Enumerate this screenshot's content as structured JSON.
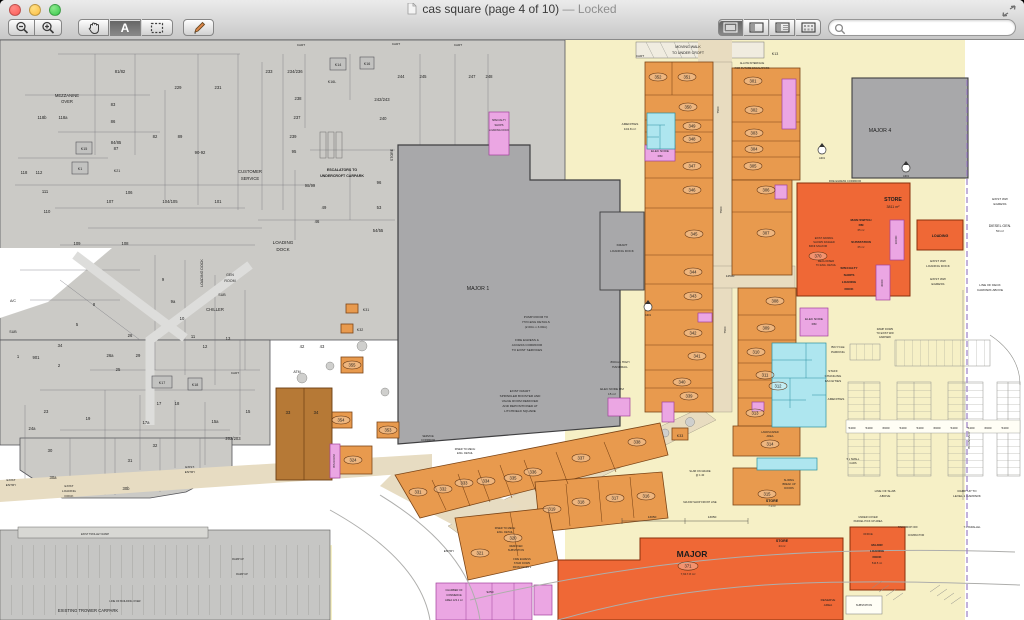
{
  "chrome": {
    "title": "cas square (page 4 of 10)",
    "locked": "— Locked",
    "search_placeholder": ""
  },
  "plan": {
    "maj": {
      "m1": "MAJOR 1",
      "m4": "MAJOR 4",
      "major": "MAJOR",
      "area371": "7,617.8 m²",
      "store": "STORE",
      "store_area": "3811 m²",
      "s71": "7.1 m²",
      "s24": "24 m²",
      "mini": "MINI MAJOR",
      "loading": "LOADING",
      "mld1": "MAJOR",
      "mld2": "LOADING",
      "mld3": "DOCK",
      "mld_area": "510.5 m²"
    },
    "shops": {
      "s301": "301",
      "s302": "302",
      "s303": "303",
      "s304": "304",
      "s305": "305",
      "s306": "306",
      "s307": "307",
      "s308": "308",
      "s309": "309",
      "s310": "310",
      "s311": "311",
      "s312": "312",
      "s313": "313",
      "s314": "314",
      "s315": "315",
      "s316": "316",
      "s317": "317",
      "s318": "318",
      "s319": "319",
      "s320": "320",
      "s321": "321",
      "s324": "324",
      "s331": "331",
      "s332": "332",
      "s333": "333",
      "s334": "334",
      "s335": "335",
      "s336": "336",
      "s337": "337",
      "s338": "338",
      "s339": "339",
      "s340": "340",
      "s341": "341",
      "s342": "342",
      "s343": "343",
      "s344": "344",
      "s345": "345",
      "s346": "346",
      "s347": "347",
      "s348": "348",
      "s349": "349",
      "s350": "350",
      "s351": "351",
      "s352": "352",
      "s353": "353",
      "s354": "354",
      "s355": "355",
      "s370": "370",
      "s371": "371"
    },
    "ex": {
      "u81_82": "81/82",
      "u83": "83",
      "u84_85": "84/85",
      "u87": "87",
      "u86": "86",
      "u82": "82",
      "u89": "89",
      "u90_92": "90-92",
      "u229": "229",
      "u231": "231",
      "u233": "233",
      "u234_236": "234/236",
      "u237": "237",
      "u238": "238",
      "u239": "239",
      "u240": "240",
      "u242_243": "242/243",
      "u244": "244",
      "u245": "245",
      "u247": "247",
      "u248": "248",
      "u95": "95",
      "u96": "96",
      "u98_99": "98/99",
      "u53": "53",
      "u54_55": "54/55",
      "u49": "49",
      "u46": "46",
      "u101": "101",
      "u104_105": "104/105",
      "u106": "106",
      "u107": "107",
      "u108": "108",
      "u109": "109",
      "u110": "110",
      "u111": "111",
      "u112": "112",
      "u118": "118",
      "u118a": "118a",
      "u118b": "118b",
      "u1": "1",
      "u2": "2",
      "u5": "5",
      "u8": "8",
      "u9": "9",
      "u9a": "9a",
      "u10": "10",
      "u11": "11",
      "u12": "12",
      "u13": "13",
      "u15": "15",
      "u15a": "15a",
      "u17": "17",
      "u17a": "17a",
      "u18": "18",
      "u19": "19",
      "u23": "23",
      "u24a": "24a",
      "u25": "25",
      "u26": "26",
      "u26a": "26a",
      "u29": "29",
      "u30": "30",
      "u30a": "30a",
      "u30b": "30b",
      "u31": "31",
      "u32": "32",
      "u33": "33",
      "u34": "34",
      "u34w": "34",
      "u42": "42",
      "u43": "43",
      "u901": "901",
      "u202_203": "202/203"
    },
    "k": {
      "k1": "K1",
      "k13": "K13",
      "k14": "K14",
      "k15": "K15",
      "k16": "K16",
      "k16l": "K16L",
      "k17": "K17",
      "k18": "K18",
      "k21": "K21",
      "k31": "K31",
      "k32": "K32",
      "k33": "K33"
    },
    "d": {
      "d7500": "7500",
      "d14500": "14500",
      "d13050": "13050",
      "d9250": "9250",
      "d5400": "5400",
      "d6600": "6600",
      "d6000": "6000",
      "d10000": "10000"
    },
    "n": {
      "mw1": "MOVING WALK",
      "mw2": "TO UNDER CROFT",
      "ai1": "ALLOW INTERFACE",
      "ai2": "FOR FUTURE ESCALATORS",
      "cart": "CART",
      "mz1": "MEZZANINE",
      "mz2": "OVER",
      "cs1": "CUSTOMER",
      "cs2": "SERVICE",
      "es1": "ESCALATORS TO",
      "es2": "UNDERCROFT CARPARK",
      "ld1": "LOADING",
      "ld2": "DOCK",
      "ldv": "LOADING DOCK",
      "gr1": "GEN",
      "gr2": "ROOM",
      "sub": "SUB",
      "chiller": "CHILLER",
      "ac": "A/C",
      "atm": "ATM",
      "storev": "STORE",
      "pump1": "PUMP ROOM TO",
      "pump2": "HYD.ENG DETAILS",
      "pump3": "(2.00m x 3.00m)",
      "fc1": "FIRE EGRESS &",
      "fc2": "ACCESS CORRIDOR",
      "fc3": "TO EXIST SERVICES",
      "km1": "EXIST KMART",
      "km2": "SPRINKLER BOOSTER AND",
      "km3": "VALVE ROOM REMOVED",
      "km4": "AND REPOSITIONED AT",
      "km5": "LITCHFIELD SQUARE",
      "kld1": "KMART",
      "kld2": "LOADING DOCK",
      "msw1": "MAIN SWITCH",
      "msw2": "RM",
      "a65": "65 m²",
      "sst": "SUBSTATION",
      "sp1": "SPECIALTY",
      "sp2": "SHOPS",
      "sp3": "LOADING",
      "sp4": "DOCK",
      "sp5": "LOADING DOCK",
      "am1": "AMENITIES",
      "am2": "104.8 m²",
      "en1": "ELEC NODE",
      "en2": "RM",
      "en3": "ELEC NODE RM",
      "en4": "15 m²",
      "mr1": "MECH RISER",
      "mr2": "TO ENG. DETAIL",
      "aw1": "EXIST AWNING",
      "aw2": "SHOWN DASHED",
      "we1": "EXIST WW",
      "we2": "EGRESS",
      "wl2": "LOADING DOCK",
      "dg1": "DIESEL GEN.",
      "dg2": "50 m²",
      "dk1": "LINE OF DECK",
      "dk2": "CARPARK ABOVE",
      "bd": "BOUNDARY",
      "bk1": "BICYCLE",
      "bk2": "PARKING",
      "st1": "STAFF",
      "st2": "CHANGING",
      "st3": "FACILITIES",
      "rd1": "RAMP DOWN",
      "rd2": "TO EXIST WW",
      "rd3": "CARPARK",
      "ru1": "RAMP UP TO",
      "ru2": "LEVEL 1 CARPARK",
      "ru": "RAMP UP",
      "sl1": "LINE OF SLAB",
      "sl2": "ABOVE",
      "lb1": "LINE OF BUILDING OVER",
      "pc1": "UNDER COVER",
      "pc2": "PARCEL PICK UP AREA",
      "tx": "TAXI DROP OFF",
      "pl": "7 x PARALLEL",
      "cp": "COMPACTOR",
      "rs1": "RESERVE",
      "rs2": "AREA",
      "off": "OFFICE",
      "sf": "MAJOR SHOP FRONT LINE",
      "fs1": "FIRE EGRESS",
      "fs2": "STAIR DOWN",
      "fs3": "FROM LEVEL 1",
      "rm1": "RISER TO MECH",
      "rm2": "ENG. DETAIL",
      "rv1": "REMOVED",
      "rv2": "SUBSTATION",
      "sc1": "SERVICE",
      "sc2": "CORRIDOR",
      "ch1": "CHAMBER OF",
      "ch2": "COMMERCE",
      "ch3": "AREA 123.1 m²",
      "ent": "ENTRY",
      "ex1": "EXIST",
      "ex2": "ENTRY",
      "exd": "EXIST.",
      "tw": "EXISTING TROWER CARPARK",
      "tr": "EXIST TROLLEY RAMP",
      "la1": "LANDSCAPED",
      "la2": "AREA",
      "sm1": "5 x SMALL",
      "sm2": "CARS",
      "sg1": "SLAB ON GRADE",
      "sg2": "@ 1:40",
      "sd1": "SLIDING",
      "sd2": "BREAK UP",
      "sd3": "DOORS",
      "hr1": "860mm HIGH",
      "hr2": "HANDRAIL",
      "fec": "FIRE EGRESS CORRIDOR",
      "a301": "A301",
      "bin": "BIN ROOM"
    }
  }
}
